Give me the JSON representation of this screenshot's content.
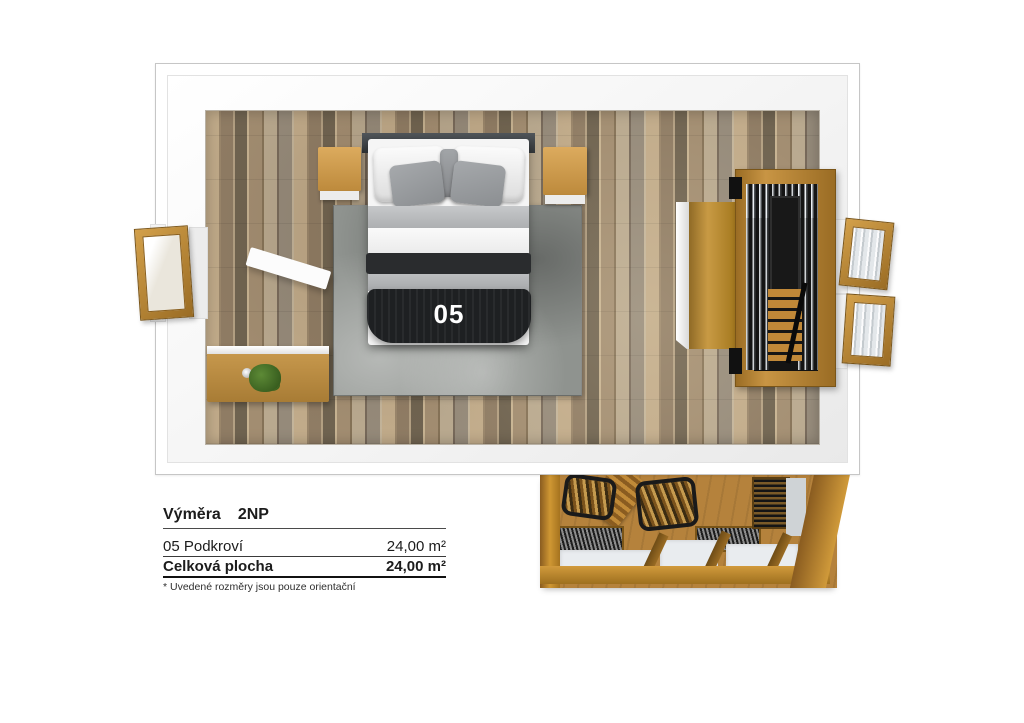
{
  "floorplan": {
    "room_number": "05",
    "furniture": [
      "double-bed",
      "rug",
      "nightstand-left",
      "nightstand-right",
      "wall-shelf",
      "dresser",
      "plant",
      "wardrobe",
      "staircase",
      "window-left",
      "window-right-top",
      "window-right-bottom",
      "lower-floor-terrace",
      "chair",
      "chair"
    ]
  },
  "legend": {
    "title": {
      "label": "Výměra",
      "floor": "2NP"
    },
    "rows": [
      {
        "name": "05 Podkroví",
        "area": "24,00 m²"
      },
      {
        "name": "Celková plocha",
        "area": "24,00 m²"
      }
    ],
    "note": "* Uvedené rozměry jsou pouze orientační"
  },
  "colors": {
    "wood_accent": "#c08a3a",
    "floor_wood": "#a8906e",
    "rug_gray": "#8f938f",
    "bed_dark": "#1e2022",
    "wall_white": "#ffffff"
  }
}
